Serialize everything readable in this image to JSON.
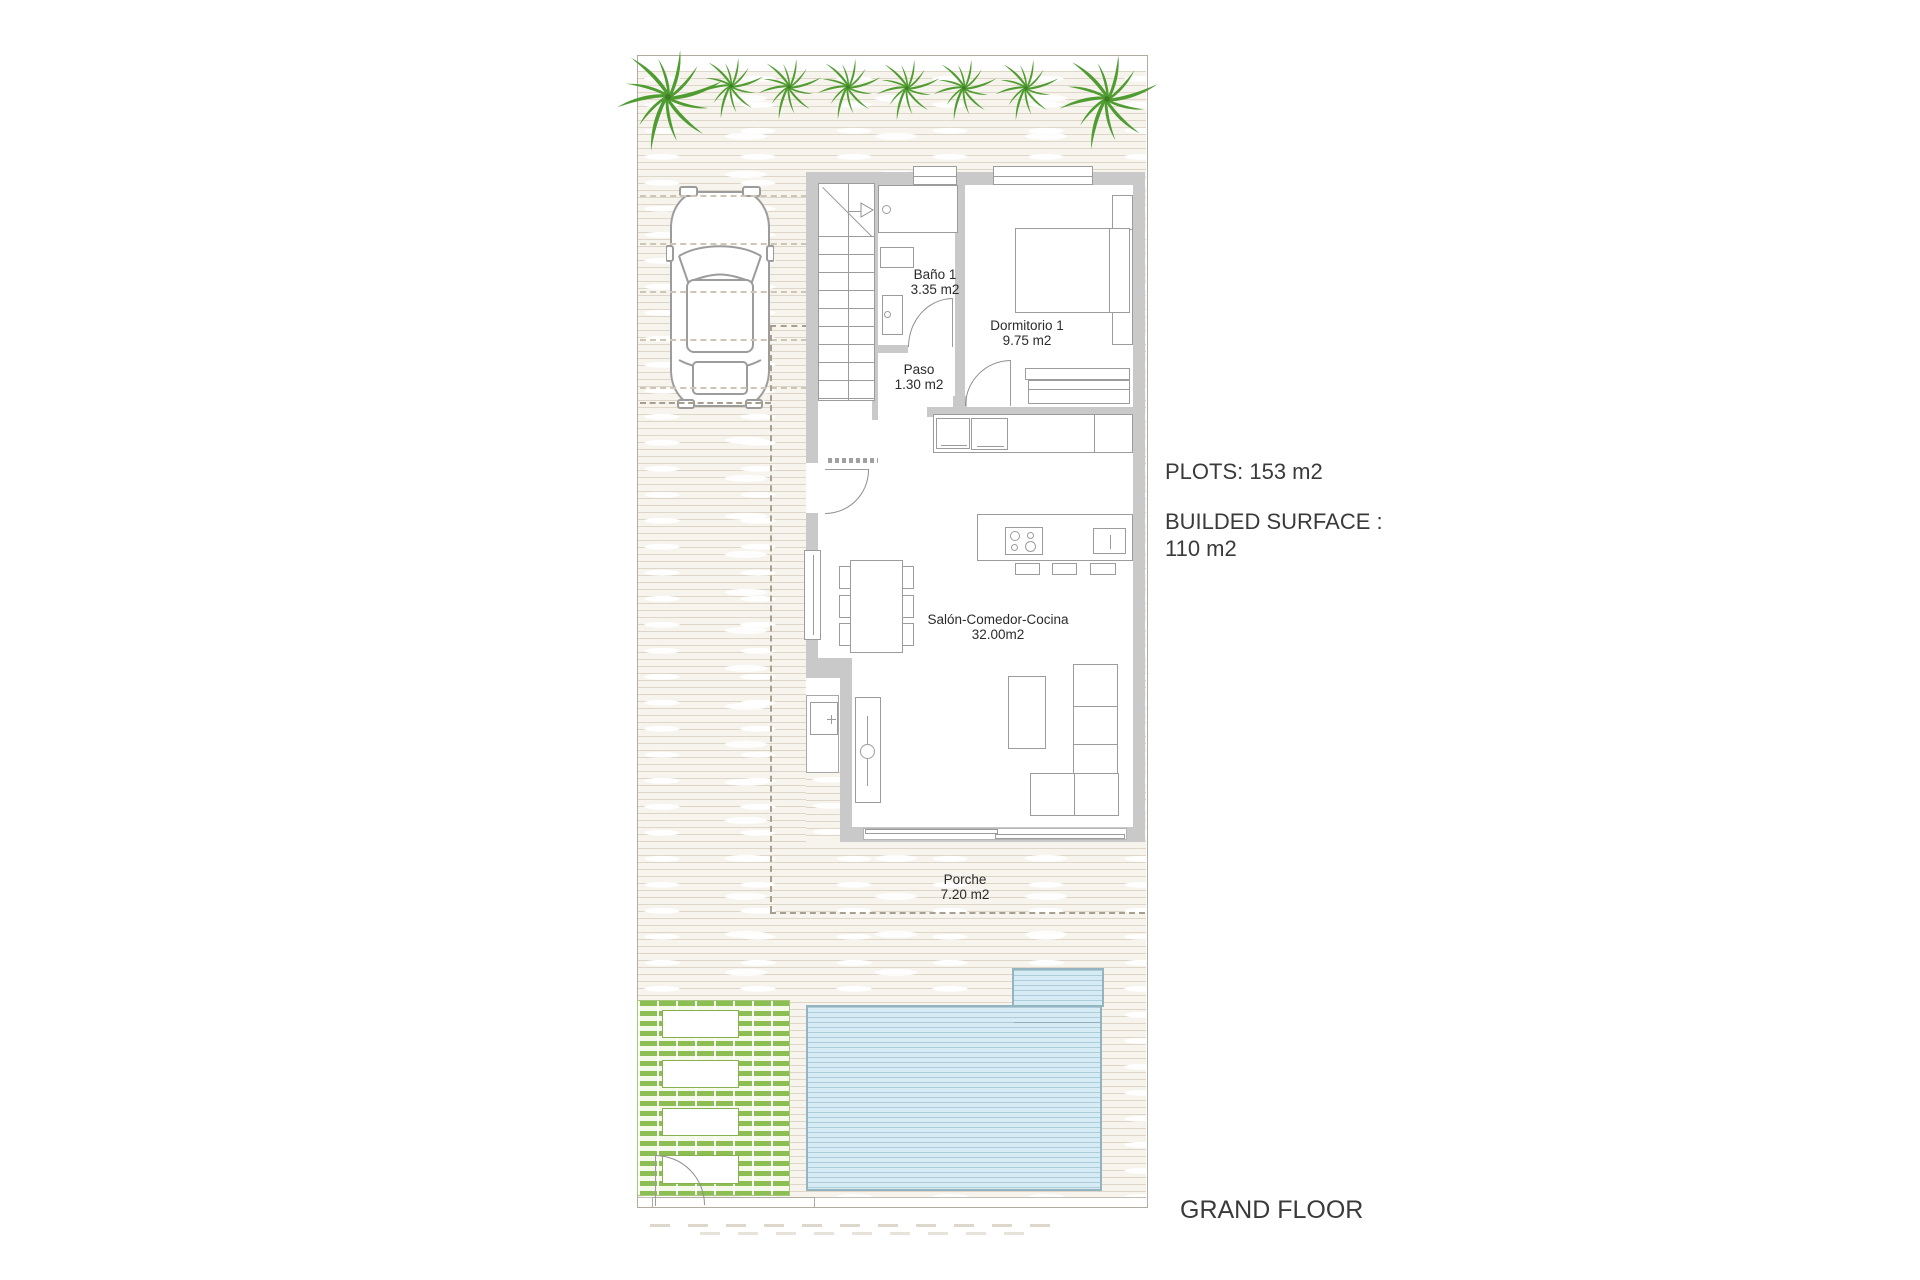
{
  "plan": {
    "rooms": {
      "bano": {
        "name": "Baño 1",
        "area": "3.35 m2"
      },
      "dormitorio": {
        "name": "Dormitorio 1",
        "area": "9.75 m2"
      },
      "paso": {
        "name": "Paso",
        "area": "1.30 m2"
      },
      "salon": {
        "name": "Salón-Comedor-Cocina",
        "area": "32.00m2"
      },
      "porche": {
        "name": "Porche",
        "area": "7.20 m2"
      }
    },
    "annotations": {
      "plots": "PLOTS: 153 m2",
      "built_surface_label": "BUILDED SURFACE :",
      "built_surface_value": "110 m2",
      "floor_title": "GRAND FLOOR"
    },
    "colors": {
      "palm_green": "#4f9c31",
      "deck_green": "#8cbe54",
      "pool_blue": "#d6ebf3",
      "pool_border": "#94b4c0",
      "wall_gray": "#c9c9c9",
      "ground_tint": "#f7f4ee",
      "text": "#333333"
    }
  }
}
